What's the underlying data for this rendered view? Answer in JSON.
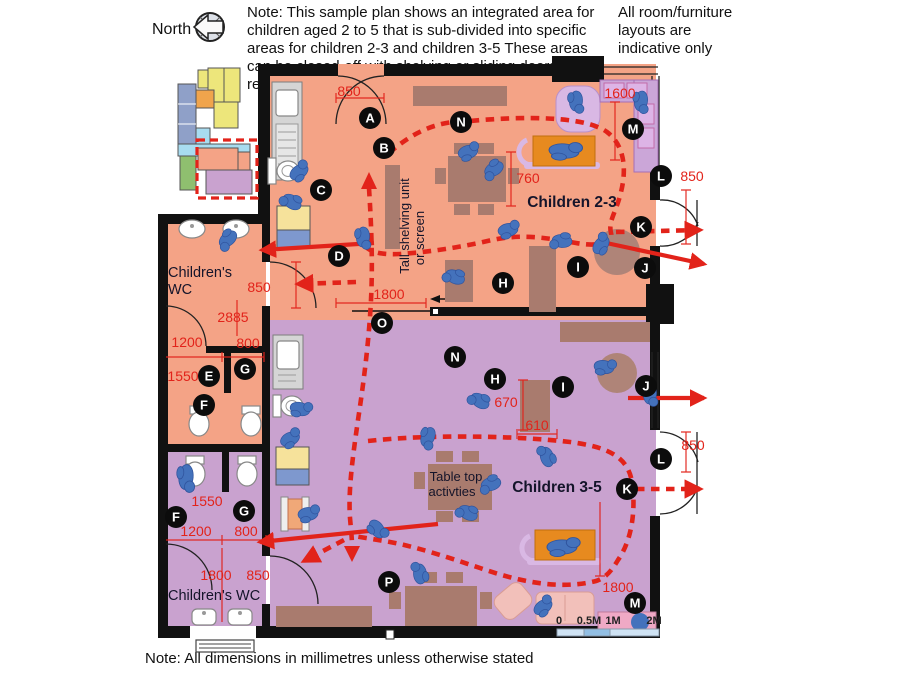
{
  "header": {
    "north_label": "North",
    "note": "Note:  This sample plan shows an integrated area for children aged 2 to 5 that is sub-divided into specific areas for children 2-3 and children 3-5 These areas can be closed-off with shelving or sliding doors as required",
    "layouts_note": "All room/furniture layouts are indicative only"
  },
  "footer": {
    "note": "Note: All dimensions in millimetres unless otherwise stated"
  },
  "scale_bar": {
    "labels": [
      "0",
      "0.5M",
      "1M",
      "2M"
    ]
  },
  "rooms": {
    "children23": "Children 2-3",
    "children35": "Children 3-5",
    "wc_upper_line1": "Children's",
    "wc_upper_line2": "WC",
    "wc_lower": "Children's WC",
    "shelving_line1": "Tall shelving unit",
    "shelving_line2": "or screen",
    "tabletop_line1": "Table top",
    "tabletop_line2": "activties"
  },
  "markers": {
    "a": "A",
    "b": "B",
    "c": "C",
    "d": "D",
    "e": "E",
    "f": "F",
    "g": "G",
    "h": "H",
    "i": "I",
    "j": "J",
    "k": "K",
    "l": "L",
    "m": "M",
    "n": "N",
    "o": "O",
    "p": "P"
  },
  "dims": {
    "top_door": "850",
    "window_seat": "1600",
    "table_23": "760",
    "right_door_upper": "850",
    "wc_upper_door": "850",
    "wc_upper_depth": "2885",
    "wc_upper_w1": "1200",
    "wc_upper_w2": "800",
    "wc_upper_len": "1550",
    "divider_opening": "1800",
    "unit_670": "670",
    "unit_610": "610",
    "right_door_lower": "850",
    "wc_lower_len": "1550",
    "wc_lower_w1": "1200",
    "wc_lower_w2": "800",
    "wc_lower_depth": "1800",
    "wc_lower_door": "850",
    "room35_wall": "1800"
  },
  "colors": {
    "area_children_23": "#f4a386",
    "area_children_35": "#c9a2cf",
    "furniture": "#a97b6e",
    "child_figure": "#4472bc",
    "circulation_red": "#e2231a",
    "daybed_orange": "#e78a1f",
    "wall_black": "#111111",
    "scale_bar_blue": "#92bfe4"
  }
}
